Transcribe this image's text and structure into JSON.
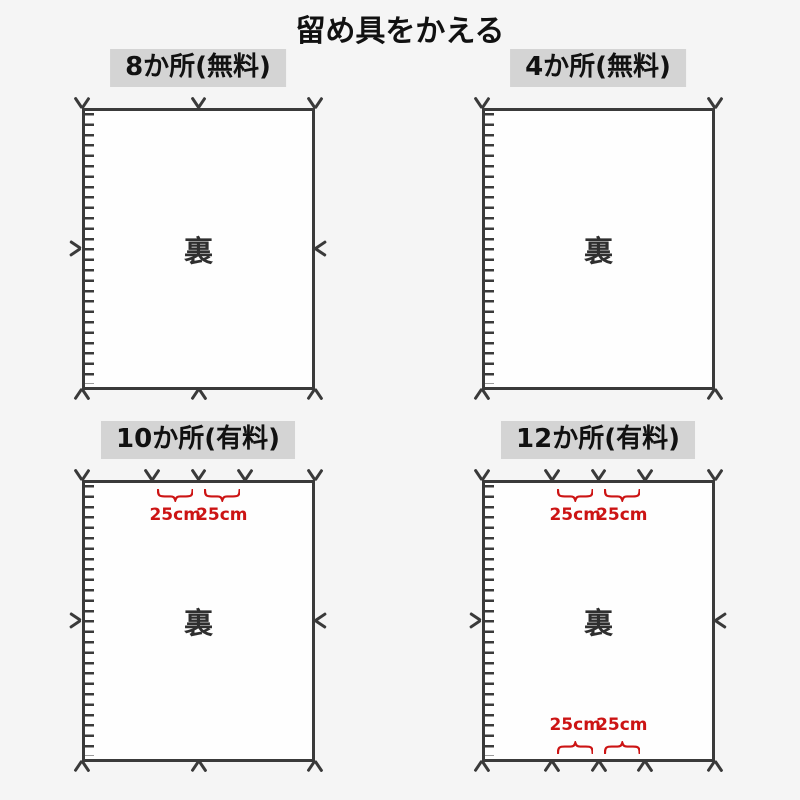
{
  "page": {
    "title": "留め具をかえる"
  },
  "colors": {
    "background": "#f5f5f5",
    "panel_fill": "#fefefe",
    "line": "#3a3a3a",
    "header_bg": "#d4d4d4",
    "annotation_red": "#cc1414"
  },
  "panels": [
    {
      "title": "8か所(無料)",
      "back_label": "裏",
      "arrows_top_fractions": [
        0,
        0.5,
        1
      ],
      "arrows_bottom_fractions": [
        0,
        0.5,
        1
      ],
      "arrow_left_middle": true,
      "arrow_right_middle": true,
      "top_braces": [],
      "bottom_braces": []
    },
    {
      "title": "4か所(無料)",
      "back_label": "裏",
      "arrows_top_fractions": [
        0,
        1
      ],
      "arrows_bottom_fractions": [
        0,
        1
      ],
      "arrow_left_middle": false,
      "arrow_right_middle": false,
      "top_braces": [],
      "bottom_braces": []
    },
    {
      "title": "10か所(有料)",
      "back_label": "裏",
      "arrows_top_fractions": [
        0,
        0.3,
        0.5,
        0.7,
        1
      ],
      "arrows_bottom_fractions": [
        0,
        0.5,
        1
      ],
      "arrow_left_middle": true,
      "arrow_right_middle": true,
      "top_braces": [
        {
          "from": 0.3,
          "to": 0.5,
          "label": "25cm"
        },
        {
          "from": 0.5,
          "to": 0.7,
          "label": "25cm"
        }
      ],
      "bottom_braces": []
    },
    {
      "title": "12か所(有料)",
      "back_label": "裏",
      "arrows_top_fractions": [
        0,
        0.3,
        0.5,
        0.7,
        1
      ],
      "arrows_bottom_fractions": [
        0,
        0.3,
        0.5,
        0.7,
        1
      ],
      "arrow_left_middle": true,
      "arrow_right_middle": true,
      "top_braces": [
        {
          "from": 0.3,
          "to": 0.5,
          "label": "25cm"
        },
        {
          "from": 0.5,
          "to": 0.7,
          "label": "25cm"
        }
      ],
      "bottom_braces": [
        {
          "from": 0.3,
          "to": 0.5,
          "label": "25cm"
        },
        {
          "from": 0.5,
          "to": 0.7,
          "label": "25cm"
        }
      ]
    }
  ]
}
